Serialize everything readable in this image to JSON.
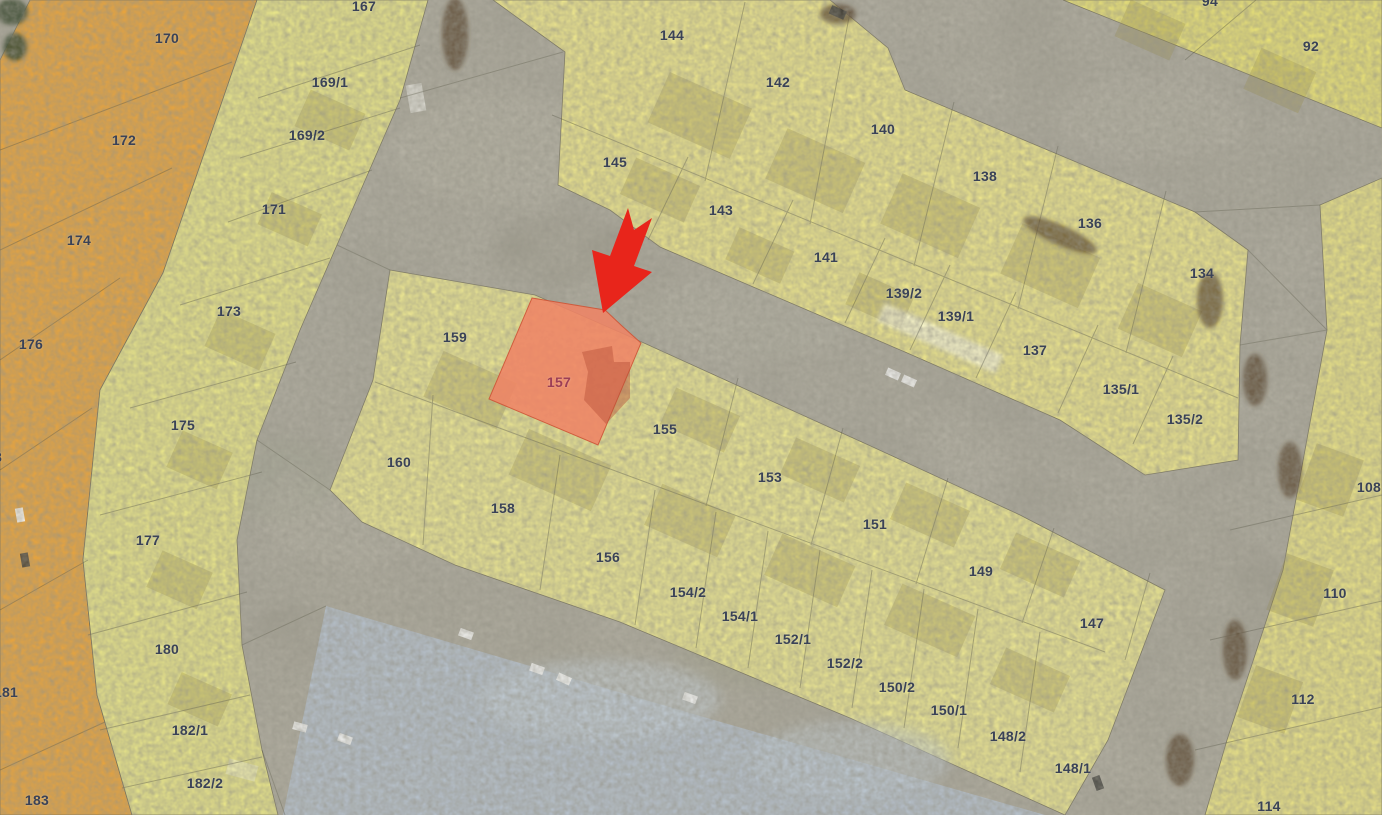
{
  "map": {
    "type": "cadastral-parcel-map-over-satellite",
    "highlighted_parcel": "157",
    "arrow_marker": {
      "shape": "arrow-pointing-down-left",
      "color": "#e8251b",
      "points_to": "157",
      "tip_x": 603,
      "tip_y": 313
    },
    "colors": {
      "orange_zone": "#e6a33e",
      "yellow_left": "#ece887",
      "yellow_top": "#f0e88a",
      "yellow_topright": "#ece473",
      "yellow_right": "#ede583",
      "yellow_central": "#efe98f",
      "highlight_fill": "#ef8465",
      "highlight_label": "#9c3e56",
      "label": "#3a4257",
      "road": "#a5a295",
      "parking": "#b5c0cb",
      "arrow": "#e8251b"
    },
    "parcels": [
      {
        "label": "170",
        "x": 167,
        "y": 38,
        "zone": "orange"
      },
      {
        "label": "172",
        "x": 124,
        "y": 140,
        "zone": "orange"
      },
      {
        "label": "174",
        "x": 79,
        "y": 240,
        "zone": "orange"
      },
      {
        "label": "176",
        "x": 31,
        "y": 344,
        "zone": "orange"
      },
      {
        "label": "178",
        "x": -10,
        "y": 457,
        "zone": "orange"
      },
      {
        "label": "181",
        "x": 6,
        "y": 692,
        "zone": "orange"
      },
      {
        "label": "183",
        "x": 37,
        "y": 800,
        "zone": "orange"
      },
      {
        "label": "167",
        "x": 364,
        "y": 6,
        "zone": "yellow-left-band"
      },
      {
        "label": "169/1",
        "x": 330,
        "y": 82,
        "zone": "yellow-left-band"
      },
      {
        "label": "169/2",
        "x": 307,
        "y": 135,
        "zone": "yellow-left-band"
      },
      {
        "label": "171",
        "x": 274,
        "y": 209,
        "zone": "yellow-left-band"
      },
      {
        "label": "173",
        "x": 229,
        "y": 311,
        "zone": "yellow-left-band"
      },
      {
        "label": "175",
        "x": 183,
        "y": 425,
        "zone": "yellow-left-band"
      },
      {
        "label": "177",
        "x": 148,
        "y": 540,
        "zone": "yellow-left-band"
      },
      {
        "label": "180",
        "x": 167,
        "y": 649,
        "zone": "yellow-left-band"
      },
      {
        "label": "182/1",
        "x": 190,
        "y": 730,
        "zone": "yellow-left-band"
      },
      {
        "label": "182/2",
        "x": 205,
        "y": 783,
        "zone": "yellow-left-band"
      },
      {
        "label": "144",
        "x": 672,
        "y": 35,
        "zone": "top-block"
      },
      {
        "label": "142",
        "x": 778,
        "y": 82,
        "zone": "top-block"
      },
      {
        "label": "140",
        "x": 883,
        "y": 129,
        "zone": "top-block"
      },
      {
        "label": "138",
        "x": 985,
        "y": 176,
        "zone": "top-block"
      },
      {
        "label": "136",
        "x": 1090,
        "y": 223,
        "zone": "top-block"
      },
      {
        "label": "134",
        "x": 1202,
        "y": 273,
        "zone": "top-block"
      },
      {
        "label": "145",
        "x": 615,
        "y": 162,
        "zone": "top-block"
      },
      {
        "label": "143",
        "x": 721,
        "y": 210,
        "zone": "top-block"
      },
      {
        "label": "141",
        "x": 826,
        "y": 257,
        "zone": "top-block"
      },
      {
        "label": "139/2",
        "x": 904,
        "y": 293,
        "zone": "top-block"
      },
      {
        "label": "139/1",
        "x": 956,
        "y": 316,
        "zone": "top-block"
      },
      {
        "label": "137",
        "x": 1035,
        "y": 350,
        "zone": "top-block"
      },
      {
        "label": "135/1",
        "x": 1121,
        "y": 389,
        "zone": "top-block"
      },
      {
        "label": "135/2",
        "x": 1185,
        "y": 419,
        "zone": "top-block"
      },
      {
        "label": "94",
        "x": 1210,
        "y": 1,
        "zone": "top-right-block"
      },
      {
        "label": "92",
        "x": 1311,
        "y": 46,
        "zone": "top-right-block"
      },
      {
        "label": "108",
        "x": 1369,
        "y": 487,
        "zone": "right-column"
      },
      {
        "label": "110",
        "x": 1335,
        "y": 593,
        "zone": "right-column"
      },
      {
        "label": "112",
        "x": 1303,
        "y": 699,
        "zone": "right-column"
      },
      {
        "label": "114",
        "x": 1269,
        "y": 806,
        "zone": "right-column"
      },
      {
        "label": "159",
        "x": 455,
        "y": 337,
        "zone": "central-block"
      },
      {
        "label": "157",
        "x": 559,
        "y": 382,
        "zone": "central-block",
        "highlighted": true
      },
      {
        "label": "155",
        "x": 665,
        "y": 429,
        "zone": "central-block"
      },
      {
        "label": "153",
        "x": 770,
        "y": 477,
        "zone": "central-block"
      },
      {
        "label": "151",
        "x": 875,
        "y": 524,
        "zone": "central-block"
      },
      {
        "label": "149",
        "x": 981,
        "y": 571,
        "zone": "central-block"
      },
      {
        "label": "147",
        "x": 1092,
        "y": 623,
        "zone": "central-block"
      },
      {
        "label": "160",
        "x": 399,
        "y": 462,
        "zone": "central-block"
      },
      {
        "label": "158",
        "x": 503,
        "y": 508,
        "zone": "central-block"
      },
      {
        "label": "156",
        "x": 608,
        "y": 557,
        "zone": "central-block"
      },
      {
        "label": "154/2",
        "x": 688,
        "y": 592,
        "zone": "central-block"
      },
      {
        "label": "154/1",
        "x": 740,
        "y": 616,
        "zone": "central-block"
      },
      {
        "label": "152/1",
        "x": 793,
        "y": 639,
        "zone": "central-block"
      },
      {
        "label": "152/2",
        "x": 845,
        "y": 663,
        "zone": "central-block"
      },
      {
        "label": "150/2",
        "x": 897,
        "y": 687,
        "zone": "central-block"
      },
      {
        "label": "150/1",
        "x": 949,
        "y": 710,
        "zone": "central-block"
      },
      {
        "label": "148/2",
        "x": 1008,
        "y": 736,
        "zone": "central-block"
      },
      {
        "label": "148/1",
        "x": 1073,
        "y": 768,
        "zone": "central-block"
      }
    ]
  }
}
